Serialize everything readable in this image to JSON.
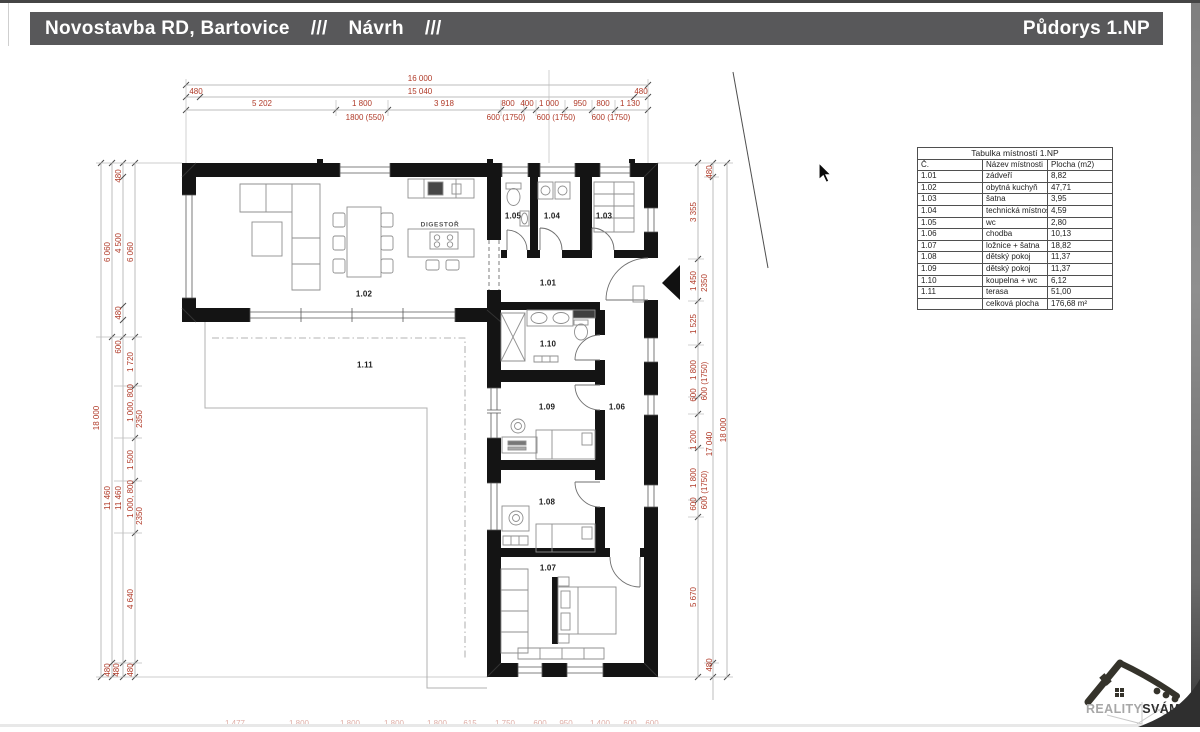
{
  "header": {
    "project_title": "Novostavba RD, Bartovice",
    "sep_a": "///",
    "phase_title": "Návrh",
    "sep_b": "///",
    "drawing_title": "Půdorys 1.NP",
    "bar_color": "#58585a",
    "text_color": "#ffffff"
  },
  "room_table": {
    "title": "Tabulka místností 1.NP",
    "columns": [
      "Č.",
      "Název místnosti",
      "Plocha (m2)"
    ],
    "rows": [
      [
        "1.01",
        "zádveří",
        "8,82"
      ],
      [
        "1.02",
        "obytná kuchyň",
        "47,71"
      ],
      [
        "1.03",
        "šatna",
        "3,95"
      ],
      [
        "1.04",
        "technická místnost",
        "4,59"
      ],
      [
        "1.05",
        "wc",
        "2,80"
      ],
      [
        "1.06",
        "chodba",
        "10,13"
      ],
      [
        "1.07",
        "ložnice + šatna",
        "18,82"
      ],
      [
        "1.08",
        "dětský pokoj",
        "11,37"
      ],
      [
        "1.09",
        "dětský pokoj",
        "11,37"
      ],
      [
        "1.10",
        "koupelna + wc",
        "6,12"
      ],
      [
        "1.11",
        "terasa",
        "51,00"
      ],
      [
        "",
        "celková plocha",
        "176,68 m²"
      ]
    ]
  },
  "plan": {
    "dim_color": "#b03a28",
    "room_labels": [
      {
        "t": "1.01",
        "x": 548,
        "y": 283
      },
      {
        "t": "1.02",
        "x": 364,
        "y": 294
      },
      {
        "t": "1.03",
        "x": 604,
        "y": 216
      },
      {
        "t": "1.04",
        "x": 552,
        "y": 216
      },
      {
        "t": "1.05",
        "x": 513,
        "y": 216
      },
      {
        "t": "1.06",
        "x": 617,
        "y": 407
      },
      {
        "t": "1.07",
        "x": 548,
        "y": 568
      },
      {
        "t": "1.08",
        "x": 547,
        "y": 502
      },
      {
        "t": "1.09",
        "x": 547,
        "y": 407
      },
      {
        "t": "1.10",
        "x": 548,
        "y": 344
      },
      {
        "t": "1.11",
        "x": 365,
        "y": 365
      }
    ],
    "appliance_label": {
      "t": "DIGESTOŘ",
      "x": 440,
      "y": 225
    },
    "dim_labels": [
      {
        "t": "16 000",
        "x": 420,
        "y": 79
      },
      {
        "t": "480",
        "x": 196,
        "y": 92
      },
      {
        "t": "15 040",
        "x": 420,
        "y": 92
      },
      {
        "t": "480",
        "x": 641,
        "y": 92
      },
      {
        "t": "5 202",
        "x": 262,
        "y": 104
      },
      {
        "t": "1 800",
        "x": 362,
        "y": 104
      },
      {
        "t": "3 918",
        "x": 444,
        "y": 104
      },
      {
        "t": "800",
        "x": 508,
        "y": 104
      },
      {
        "t": "400",
        "x": 527,
        "y": 104
      },
      {
        "t": "1 000",
        "x": 549,
        "y": 104
      },
      {
        "t": "950",
        "x": 580,
        "y": 104
      },
      {
        "t": "800",
        "x": 603,
        "y": 104
      },
      {
        "t": "1 130",
        "x": 630,
        "y": 104
      },
      {
        "t": "1800 (550)",
        "x": 365,
        "y": 118
      },
      {
        "t": "600 (1750)",
        "x": 506,
        "y": 118
      },
      {
        "t": "600 (1750)",
        "x": 556,
        "y": 118
      },
      {
        "t": "600 (1750)",
        "x": 611,
        "y": 118
      },
      {
        "t": "18 000",
        "x": 97,
        "y": 418,
        "r": 1
      },
      {
        "t": "6 060",
        "x": 108,
        "y": 252,
        "r": 1
      },
      {
        "t": "11 460",
        "x": 108,
        "y": 498,
        "r": 1
      },
      {
        "t": "480",
        "x": 108,
        "y": 670,
        "r": 1
      },
      {
        "t": "480",
        "x": 119,
        "y": 176,
        "r": 1
      },
      {
        "t": "4 500",
        "x": 119,
        "y": 243,
        "r": 1
      },
      {
        "t": "480",
        "x": 119,
        "y": 313,
        "r": 1
      },
      {
        "t": "600",
        "x": 119,
        "y": 347,
        "r": 1
      },
      {
        "t": "11 460",
        "x": 119,
        "y": 498,
        "r": 1
      },
      {
        "t": "480",
        "x": 117,
        "y": 670,
        "r": 1
      },
      {
        "t": "6 060",
        "x": 131,
        "y": 252,
        "r": 1
      },
      {
        "t": "1 720",
        "x": 131,
        "y": 362,
        "r": 1
      },
      {
        "t": "1 000, 800",
        "x": 131,
        "y": 403,
        "r": 1
      },
      {
        "t": "2350",
        "x": 140,
        "y": 419,
        "r": 1
      },
      {
        "t": "1 500",
        "x": 131,
        "y": 460,
        "r": 1
      },
      {
        "t": "1 000, 800",
        "x": 131,
        "y": 499,
        "r": 1
      },
      {
        "t": "2350",
        "x": 140,
        "y": 516,
        "r": 1
      },
      {
        "t": "4 640",
        "x": 131,
        "y": 599,
        "r": 1
      },
      {
        "t": "480",
        "x": 131,
        "y": 670,
        "r": 1
      },
      {
        "t": "3 355",
        "x": 694,
        "y": 212,
        "r": 1
      },
      {
        "t": "1 450",
        "x": 694,
        "y": 281,
        "r": 1
      },
      {
        "t": "2350",
        "x": 705,
        "y": 283,
        "r": 1
      },
      {
        "t": "1 525",
        "x": 694,
        "y": 324,
        "r": 1
      },
      {
        "t": "1 800",
        "x": 694,
        "y": 370,
        "r": 1
      },
      {
        "t": "600 (1750)",
        "x": 705,
        "y": 381,
        "r": 1
      },
      {
        "t": "600",
        "x": 694,
        "y": 395,
        "r": 1
      },
      {
        "t": "1 200",
        "x": 694,
        "y": 440,
        "r": 1
      },
      {
        "t": "1 800",
        "x": 694,
        "y": 478,
        "r": 1
      },
      {
        "t": "600 (1750)",
        "x": 705,
        "y": 490,
        "r": 1
      },
      {
        "t": "600",
        "x": 694,
        "y": 504,
        "r": 1
      },
      {
        "t": "5 670",
        "x": 694,
        "y": 597,
        "r": 1
      },
      {
        "t": "480",
        "x": 710,
        "y": 172,
        "r": 1
      },
      {
        "t": "17 040",
        "x": 710,
        "y": 444,
        "r": 1
      },
      {
        "t": "480",
        "x": 710,
        "y": 665,
        "r": 1
      },
      {
        "t": "18 000",
        "x": 724,
        "y": 430,
        "r": 1
      },
      {
        "t": "1 477",
        "x": 235,
        "y": 724,
        "f": 1
      },
      {
        "t": "1 800",
        "x": 299,
        "y": 724,
        "f": 1
      },
      {
        "t": "1 800",
        "x": 350,
        "y": 724,
        "f": 1
      },
      {
        "t": "1 800",
        "x": 394,
        "y": 724,
        "f": 1
      },
      {
        "t": "1 800",
        "x": 437,
        "y": 724,
        "f": 1
      },
      {
        "t": "615",
        "x": 470,
        "y": 724,
        "f": 1
      },
      {
        "t": "1 750",
        "x": 505,
        "y": 724,
        "f": 1
      },
      {
        "t": "600",
        "x": 540,
        "y": 724,
        "f": 1
      },
      {
        "t": "950",
        "x": 566,
        "y": 724,
        "f": 1
      },
      {
        "t": "1 400",
        "x": 600,
        "y": 724,
        "f": 1
      },
      {
        "t": "600",
        "x": 630,
        "y": 724,
        "f": 1
      },
      {
        "t": "600",
        "x": 652,
        "y": 724,
        "f": 1
      }
    ],
    "dim_chains": [
      {
        "o": "h",
        "p": 85,
        "a": 186,
        "b": 648,
        "t": [
          186,
          648
        ]
      },
      {
        "o": "h",
        "p": 97,
        "a": 186,
        "b": 648,
        "t": [
          186,
          200,
          634,
          648
        ]
      },
      {
        "o": "h",
        "p": 110,
        "a": 186,
        "b": 648,
        "t": [
          186,
          336,
          388,
          501,
          524,
          536,
          565,
          592,
          615,
          648
        ]
      },
      {
        "o": "v",
        "p": 101,
        "a": 163,
        "b": 677,
        "t": [
          163,
          677
        ]
      },
      {
        "o": "v",
        "p": 112,
        "a": 163,
        "b": 677,
        "t": [
          163,
          337,
          663,
          677
        ]
      },
      {
        "o": "v",
        "p": 123,
        "a": 163,
        "b": 677,
        "t": [
          163,
          177,
          306,
          320,
          337,
          663,
          677
        ]
      },
      {
        "o": "v",
        "p": 135,
        "a": 163,
        "b": 677,
        "t": [
          163,
          337,
          386,
          438,
          481,
          533,
          663,
          677
        ]
      },
      {
        "o": "v",
        "p": 698,
        "a": 163,
        "b": 677,
        "t": [
          163,
          259,
          301,
          345,
          397,
          414,
          448,
          500,
          517,
          677
        ]
      },
      {
        "o": "v",
        "p": 713,
        "a": 163,
        "b": 700,
        "t": [
          163,
          177,
          663,
          677
        ]
      },
      {
        "o": "v",
        "p": 727,
        "a": 163,
        "b": 677,
        "t": [
          163,
          677
        ]
      }
    ],
    "ext_lines": [
      [
        549,
        70,
        549,
        163
      ],
      [
        186,
        79,
        186,
        163
      ],
      [
        648,
        79,
        648,
        163
      ],
      [
        336,
        100,
        336,
        116
      ],
      [
        388,
        100,
        388,
        116
      ],
      [
        501,
        100,
        501,
        116
      ],
      [
        524,
        100,
        524,
        116
      ],
      [
        536,
        100,
        536,
        116
      ],
      [
        565,
        100,
        565,
        116
      ],
      [
        592,
        100,
        592,
        116
      ],
      [
        615,
        100,
        615,
        116
      ],
      [
        96,
        163,
        182,
        163
      ],
      [
        96,
        677,
        487,
        677
      ],
      [
        96,
        337,
        142,
        337
      ],
      [
        114,
        386,
        142,
        386
      ],
      [
        114,
        438,
        142,
        438
      ],
      [
        114,
        481,
        142,
        481
      ],
      [
        114,
        533,
        142,
        533
      ],
      [
        114,
        663,
        142,
        663
      ],
      [
        658,
        163,
        733,
        163
      ],
      [
        658,
        677,
        733,
        677
      ],
      [
        688,
        259,
        704,
        259
      ],
      [
        688,
        301,
        704,
        301
      ],
      [
        688,
        345,
        704,
        345
      ],
      [
        688,
        397,
        704,
        397
      ],
      [
        688,
        414,
        704,
        414
      ],
      [
        688,
        448,
        704,
        448
      ],
      [
        688,
        500,
        704,
        500
      ],
      [
        688,
        517,
        704,
        517
      ],
      [
        704,
        177,
        719,
        177
      ],
      [
        704,
        663,
        719,
        663
      ]
    ]
  },
  "logo": {
    "brand_light": "REALITY",
    "brand_bold": "SVÁMI"
  },
  "cursor": {
    "x": 818,
    "y": 162
  }
}
